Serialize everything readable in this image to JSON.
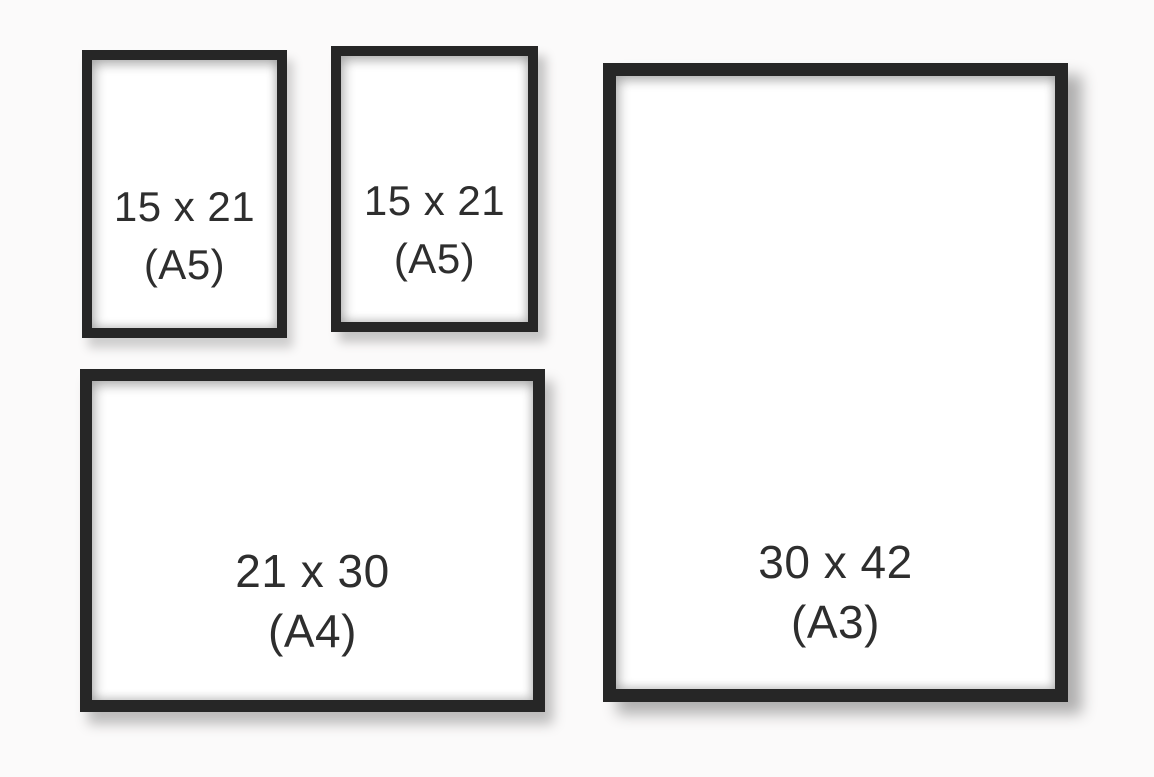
{
  "colors": {
    "background": "#fbfafa",
    "frame": "#262626",
    "paper": "#ffffff",
    "text": "#2e2e2e"
  },
  "frames": [
    {
      "id": "a5-top-left",
      "orientation": "portrait",
      "size_label": "15 x 21",
      "format_label": "(A5)"
    },
    {
      "id": "a5-top-middle",
      "orientation": "portrait",
      "size_label": "15 x 21",
      "format_label": "(A5)"
    },
    {
      "id": "a4-bottom-left",
      "orientation": "landscape",
      "size_label": "21 x 30",
      "format_label": "(A4)"
    },
    {
      "id": "a3-right",
      "orientation": "portrait",
      "size_label": "30 x 42",
      "format_label": "(A3)"
    }
  ]
}
